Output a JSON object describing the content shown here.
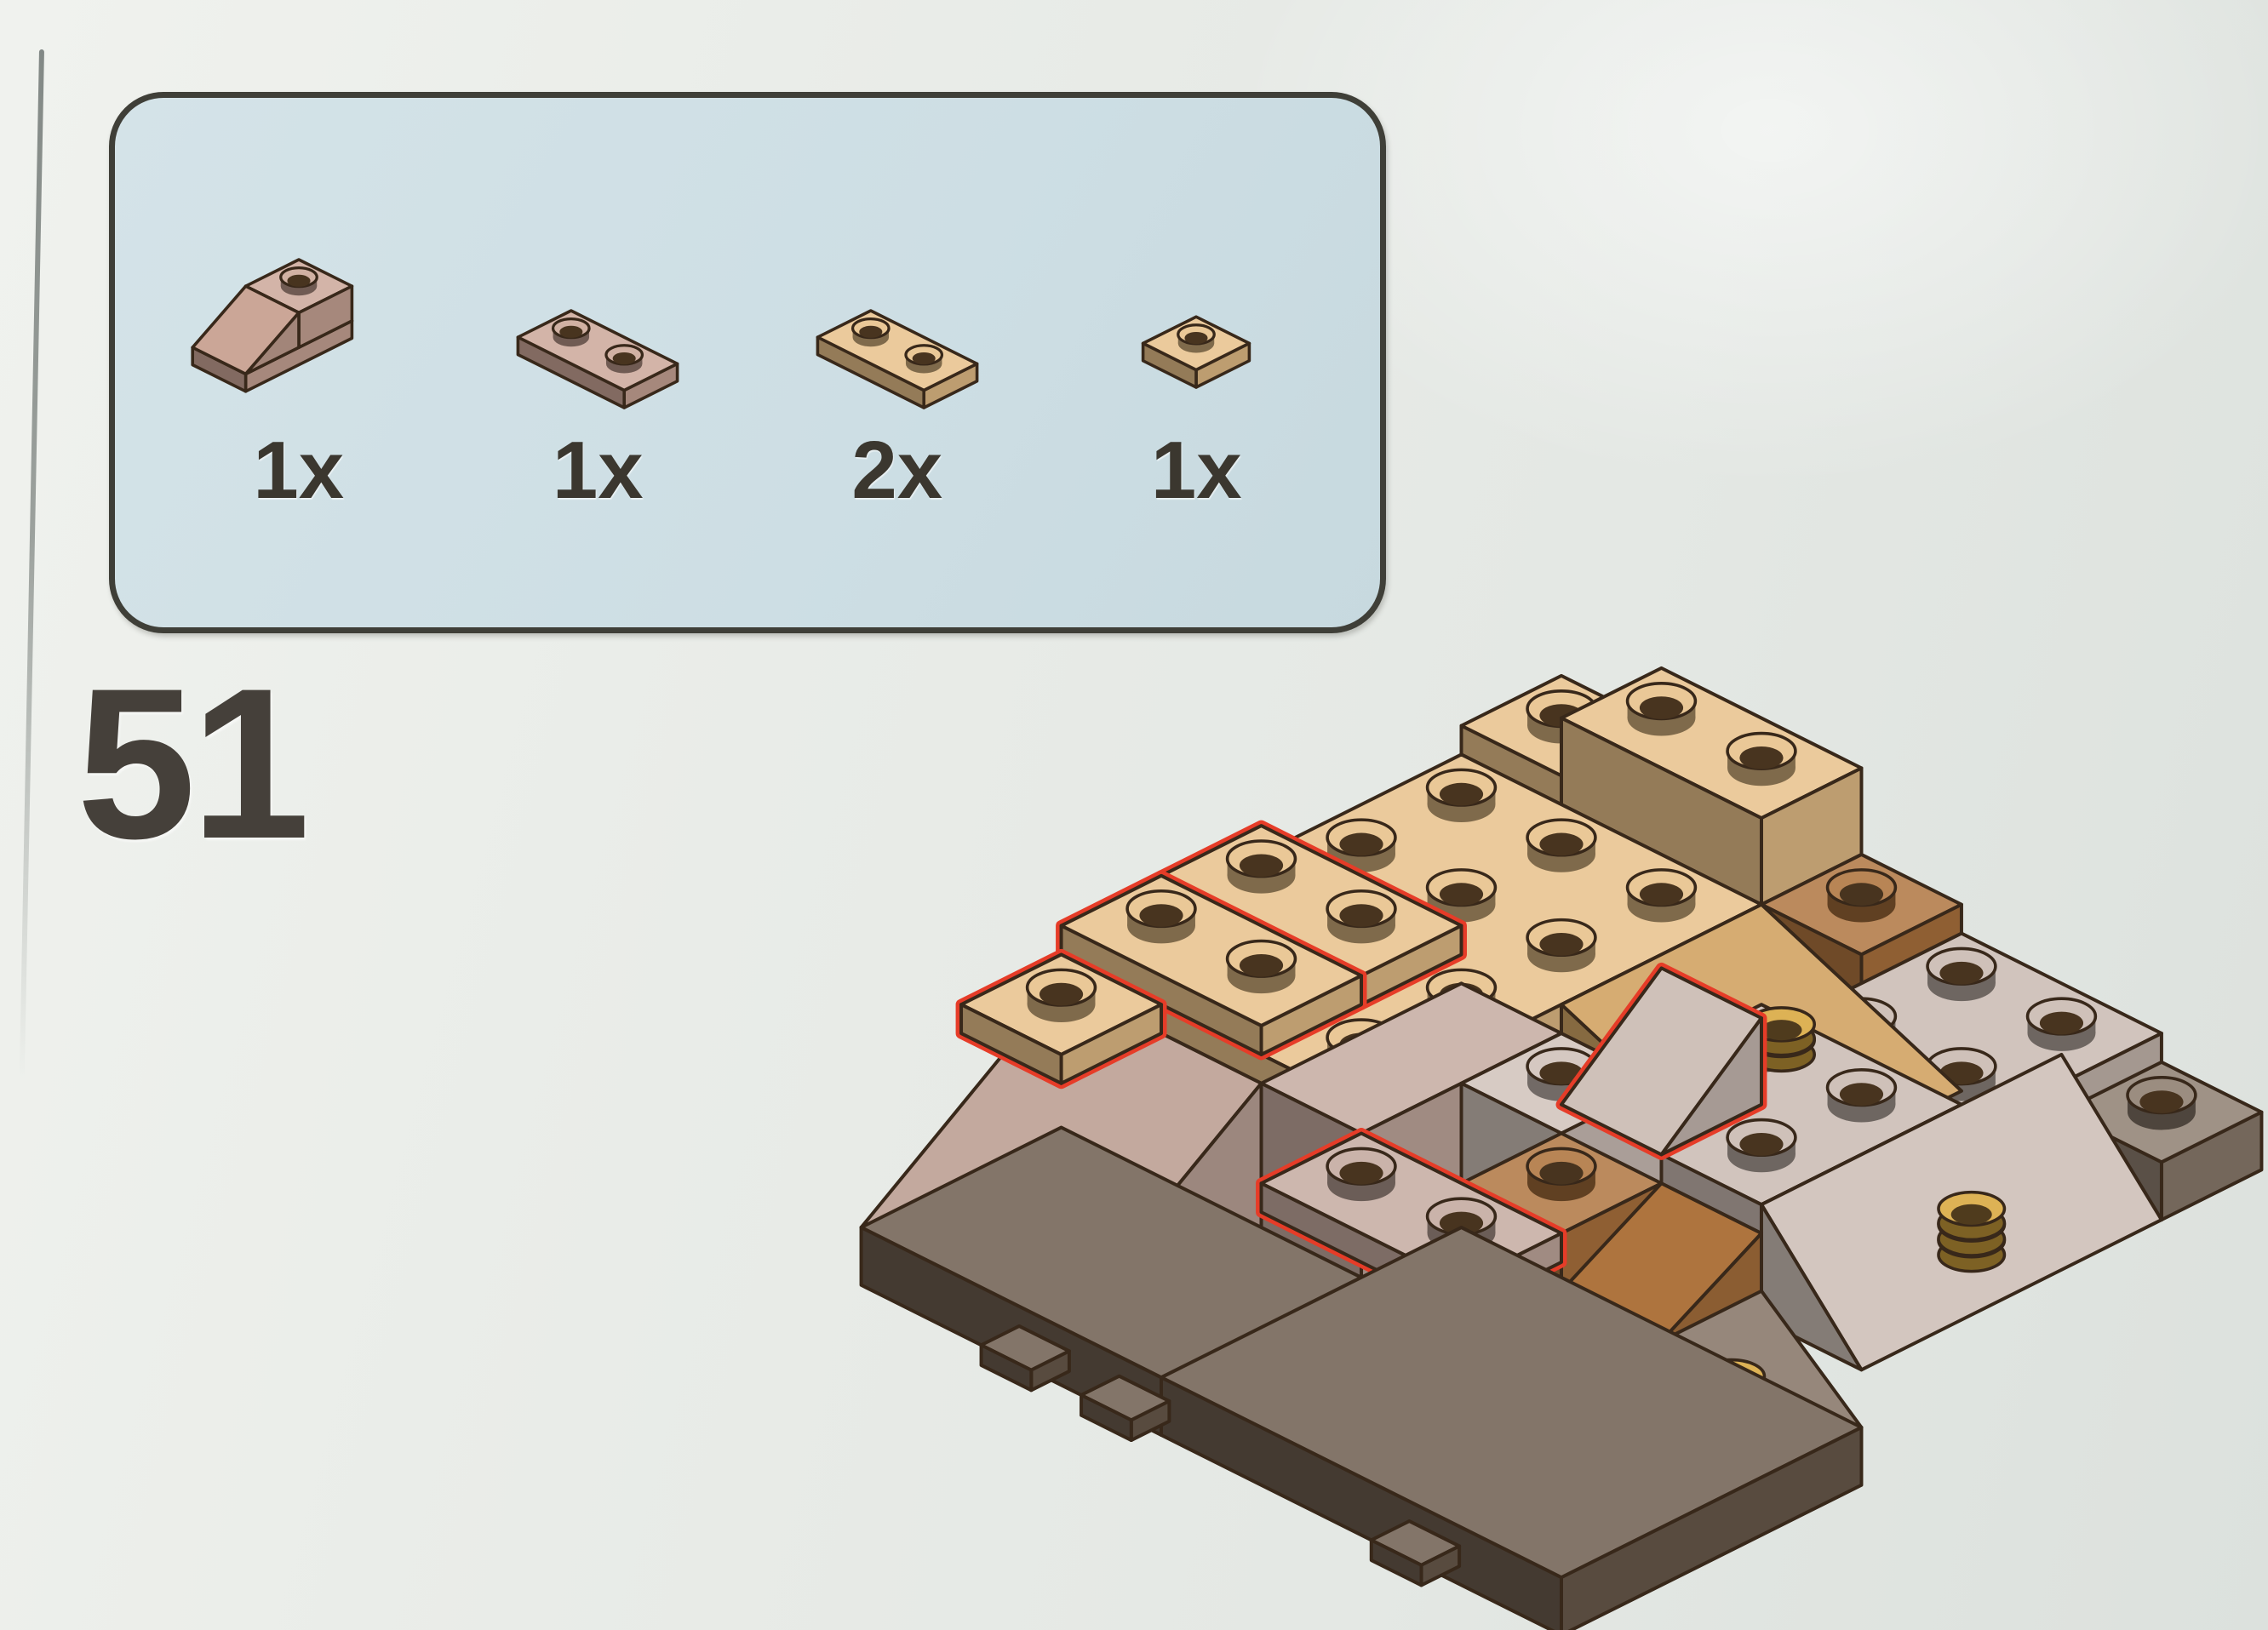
{
  "page": {
    "step_number": "51",
    "background_color": "#e9ece8",
    "panel_background": "#cfdfe4",
    "panel_border_color": "#3f3f38"
  },
  "parts_panel": {
    "parts": [
      {
        "id": "slope-45-1x2-dark-tan",
        "count_label": "1x",
        "color_key": "pink",
        "view": {
          "ox": 130,
          "oy": 96
        },
        "pieces": [
          {
            "t": "box",
            "x": 0,
            "y": 0,
            "z": 0,
            "w": 1,
            "d": 2,
            "h": 1,
            "c": "pink"
          },
          {
            "t": "box",
            "x": 0,
            "y": 0,
            "z": 1,
            "w": 1,
            "d": 1,
            "h": 2,
            "c": "pink",
            "s": 1
          },
          {
            "t": "slopeS",
            "x": 0,
            "y": 1,
            "z": 1,
            "w": 1,
            "d": 1,
            "h": 2,
            "c": "pink"
          }
        ]
      },
      {
        "id": "plate-1x2-dark-tan",
        "count_label": "1x",
        "color_key": "pink",
        "view": {
          "ox": 104,
          "oy": 112
        },
        "pieces": [
          {
            "t": "box",
            "x": 0,
            "y": 0,
            "z": 0,
            "w": 2,
            "d": 1,
            "h": 1,
            "c": "pink",
            "s": 1
          }
        ]
      },
      {
        "id": "plate-1x2-tan",
        "count_label": "2x",
        "color_key": "tan",
        "view": {
          "ox": 104,
          "oy": 112
        },
        "pieces": [
          {
            "t": "box",
            "x": 0,
            "y": 0,
            "z": 0,
            "w": 2,
            "d": 1,
            "h": 1,
            "c": "tan",
            "s": 1
          }
        ]
      },
      {
        "id": "plate-1x1-tan",
        "count_label": "1x",
        "color_key": "tan",
        "view": {
          "ox": 130,
          "oy": 118
        },
        "pieces": [
          {
            "t": "box",
            "x": 0,
            "y": 0,
            "z": 0,
            "w": 1,
            "d": 1,
            "h": 1,
            "c": "tan",
            "s": 1
          }
        ]
      }
    ]
  },
  "illustration": {
    "name": "lego-rock-outcrop-step-51",
    "highlight_color": "#e63c28",
    "outline_color": "#38281a",
    "palette": {
      "tan": "#e7c089",
      "tanDark": "#d2a566",
      "sand": "#c3a99e",
      "sandLight": "#cfc1b9",
      "gray": "#c8b9b0",
      "nougat": "#ae743e",
      "darkGray": "#8d7d6f",
      "darkest": "#6b5b4d",
      "yellow": "#e6b05a",
      "coin": "#d8a73e",
      "pink": "#cba697"
    },
    "bricks": [
      {
        "t": "box",
        "x": 0,
        "y": 0,
        "z": 8,
        "w": 1,
        "d": 1,
        "h": 1,
        "c": "tan",
        "s": 1
      },
      {
        "t": "box",
        "x": 1,
        "y": 0,
        "z": 8,
        "w": 2,
        "d": 1,
        "h": 3,
        "c": "tan",
        "s": 1
      },
      {
        "t": "box",
        "x": 3,
        "y": 0,
        "z": 6,
        "w": 1,
        "d": 1,
        "h": 2,
        "c": "nougat",
        "s": 1
      },
      {
        "t": "box",
        "x": 4,
        "y": 0,
        "z": 6,
        "w": 2,
        "d": 2,
        "h": 1,
        "c": "gray",
        "s": 1
      },
      {
        "t": "box",
        "x": 6,
        "y": 0,
        "z": 4,
        "w": 1,
        "d": 1,
        "h": 2,
        "c": "darkGray",
        "s": 1
      },
      {
        "t": "box",
        "x": 0,
        "y": 1,
        "z": 7,
        "w": 3,
        "d": 4,
        "h": 1,
        "c": "tan",
        "s": 1
      },
      {
        "t": "slopeE",
        "x": 3,
        "y": 1,
        "z": 5,
        "w": 2,
        "d": 2,
        "h": 3,
        "c": "tanDark"
      },
      {
        "t": "box",
        "x": 4,
        "y": 2,
        "z": 7,
        "w": 2,
        "d": 2,
        "h": 1,
        "c": "gray",
        "s": 1
      },
      {
        "t": "slopeE",
        "x": 6,
        "y": 1,
        "z": 4,
        "w": 1,
        "d": 3,
        "h": 4,
        "c": "sandLight"
      },
      {
        "t": "cyl",
        "x": 4.6,
        "y": 2.4,
        "z": 8,
        "n": 2,
        "c": "coin"
      },
      {
        "t": "box",
        "x": 0,
        "y": 3,
        "z": 8,
        "w": 2,
        "d": 1,
        "h": 1,
        "c": "tan",
        "s": 1,
        "hl": 1
      },
      {
        "t": "box",
        "x": 0,
        "y": 4,
        "z": 8,
        "w": 2,
        "d": 1,
        "h": 1,
        "c": "tan",
        "s": 1,
        "hl": 1
      },
      {
        "t": "slopeS",
        "x": 0,
        "y": 5,
        "z": 2,
        "w": 2,
        "d": 2,
        "h": 5,
        "c": "sand"
      },
      {
        "t": "box",
        "x": 0,
        "y": 5,
        "z": 7,
        "w": 1,
        "d": 1,
        "h": 1,
        "c": "tan",
        "s": 1,
        "hl": 1
      },
      {
        "t": "box",
        "x": 2,
        "y": 3,
        "z": 2,
        "w": 1,
        "d": 2,
        "h": 5,
        "c": "sand"
      },
      {
        "t": "box",
        "x": 3,
        "y": 3,
        "z": 2,
        "w": 1,
        "d": 1,
        "h": 5,
        "c": "sandLight",
        "s": 1
      },
      {
        "t": "slopeS",
        "x": 4,
        "y": 3,
        "z": 8,
        "w": 1,
        "d": 1,
        "h": 3,
        "c": "sandLight",
        "hl": 1
      },
      {
        "t": "box",
        "x": 4,
        "y": 4,
        "z": 4,
        "w": 1,
        "d": 1,
        "h": 3,
        "c": "nougat",
        "s": 1
      },
      {
        "t": "slopeS",
        "x": 5,
        "y": 4,
        "z": 3,
        "w": 1,
        "d": 2,
        "h": 4,
        "c": "nougat"
      },
      {
        "t": "box",
        "x": 3,
        "y": 5,
        "z": 2,
        "w": 1,
        "d": 1,
        "h": 4,
        "c": "sand"
      },
      {
        "t": "box",
        "x": 3,
        "y": 5,
        "z": 6,
        "w": 2,
        "d": 1,
        "h": 1,
        "c": "sand",
        "s": 1,
        "hl": 1
      },
      {
        "t": "slopeS",
        "x": 2,
        "y": 6,
        "z": 2,
        "w": 1,
        "d": 1,
        "h": 2,
        "c": "yellow"
      },
      {
        "t": "slopeS",
        "x": 3,
        "y": 6,
        "z": 2,
        "w": 2,
        "d": 1,
        "h": 3,
        "c": "darkGray"
      },
      {
        "t": "box",
        "x": 5,
        "y": 5,
        "z": 2,
        "w": 1,
        "d": 1,
        "h": 2,
        "c": "darkest",
        "s": 1
      },
      {
        "t": "slopeE",
        "x": 6,
        "y": 4,
        "z": 2,
        "w": 1,
        "d": 2,
        "h": 3,
        "c": "darkGray"
      },
      {
        "t": "cyl",
        "x": 6.4,
        "y": 2.3,
        "z": 4,
        "n": 3,
        "c": "coin"
      },
      {
        "t": "cyl",
        "x": 6.3,
        "y": 4.6,
        "z": 2,
        "n": 3,
        "c": "coin"
      },
      {
        "t": "box",
        "x": 0,
        "y": 5,
        "z": 0,
        "w": 3,
        "d": 2,
        "h": 2,
        "c": "darkest"
      },
      {
        "t": "box",
        "x": 3,
        "y": 4,
        "z": 0,
        "w": 4,
        "d": 3,
        "h": 2,
        "c": "darkest"
      },
      {
        "t": "box",
        "x": 1.2,
        "y": 6.62,
        "z": -0.7,
        "w": 0.5,
        "d": 0.38,
        "h": 0.7,
        "c": "darkest"
      },
      {
        "t": "box",
        "x": 2.2,
        "y": 6.62,
        "z": -0.7,
        "w": 0.5,
        "d": 0.38,
        "h": 0.7,
        "c": "darkest"
      },
      {
        "t": "box",
        "x": 5.1,
        "y": 6.62,
        "z": -0.7,
        "w": 0.5,
        "d": 0.38,
        "h": 0.7,
        "c": "darkest"
      }
    ]
  }
}
